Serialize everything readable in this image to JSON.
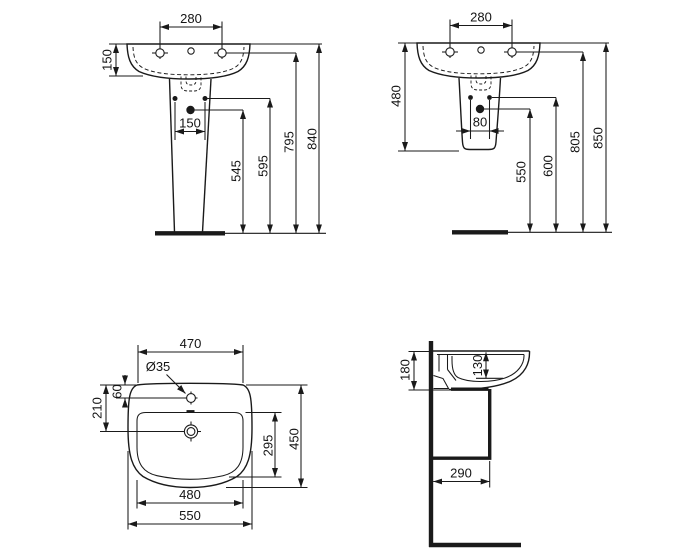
{
  "colors": {
    "background": "#ffffff",
    "line": "#1a1a1a"
  },
  "views": {
    "front_pedestal": {
      "dims": {
        "tap_hole_spacing": "280",
        "basin_rim_height": "150",
        "fixing_hole_spacing": "150",
        "outlet_height": "545",
        "fixing_height": "595",
        "tap_deck_height": "795",
        "overall_height": "840"
      }
    },
    "front_semi_pedestal": {
      "dims": {
        "tap_hole_spacing": "280",
        "basin_semi_pedestal_height": "480",
        "fixing_hole_spacing": "80",
        "outlet_height": "550",
        "fixing_height": "600",
        "tap_deck_height": "805",
        "rim_height": "850"
      }
    },
    "plan": {
      "dims": {
        "rear_width": "470",
        "tap_hole_diameter": "Ø35",
        "tap_hole_offset": "60",
        "drain_offset": "210",
        "bowl_depth": "295",
        "overall_depth": "450",
        "bowl_width": "480",
        "overall_width": "550"
      }
    },
    "side": {
      "dims": {
        "basin_front_height": "180",
        "bowl_inner_depth": "130",
        "outlet_distance_from_wall": "290"
      }
    }
  }
}
